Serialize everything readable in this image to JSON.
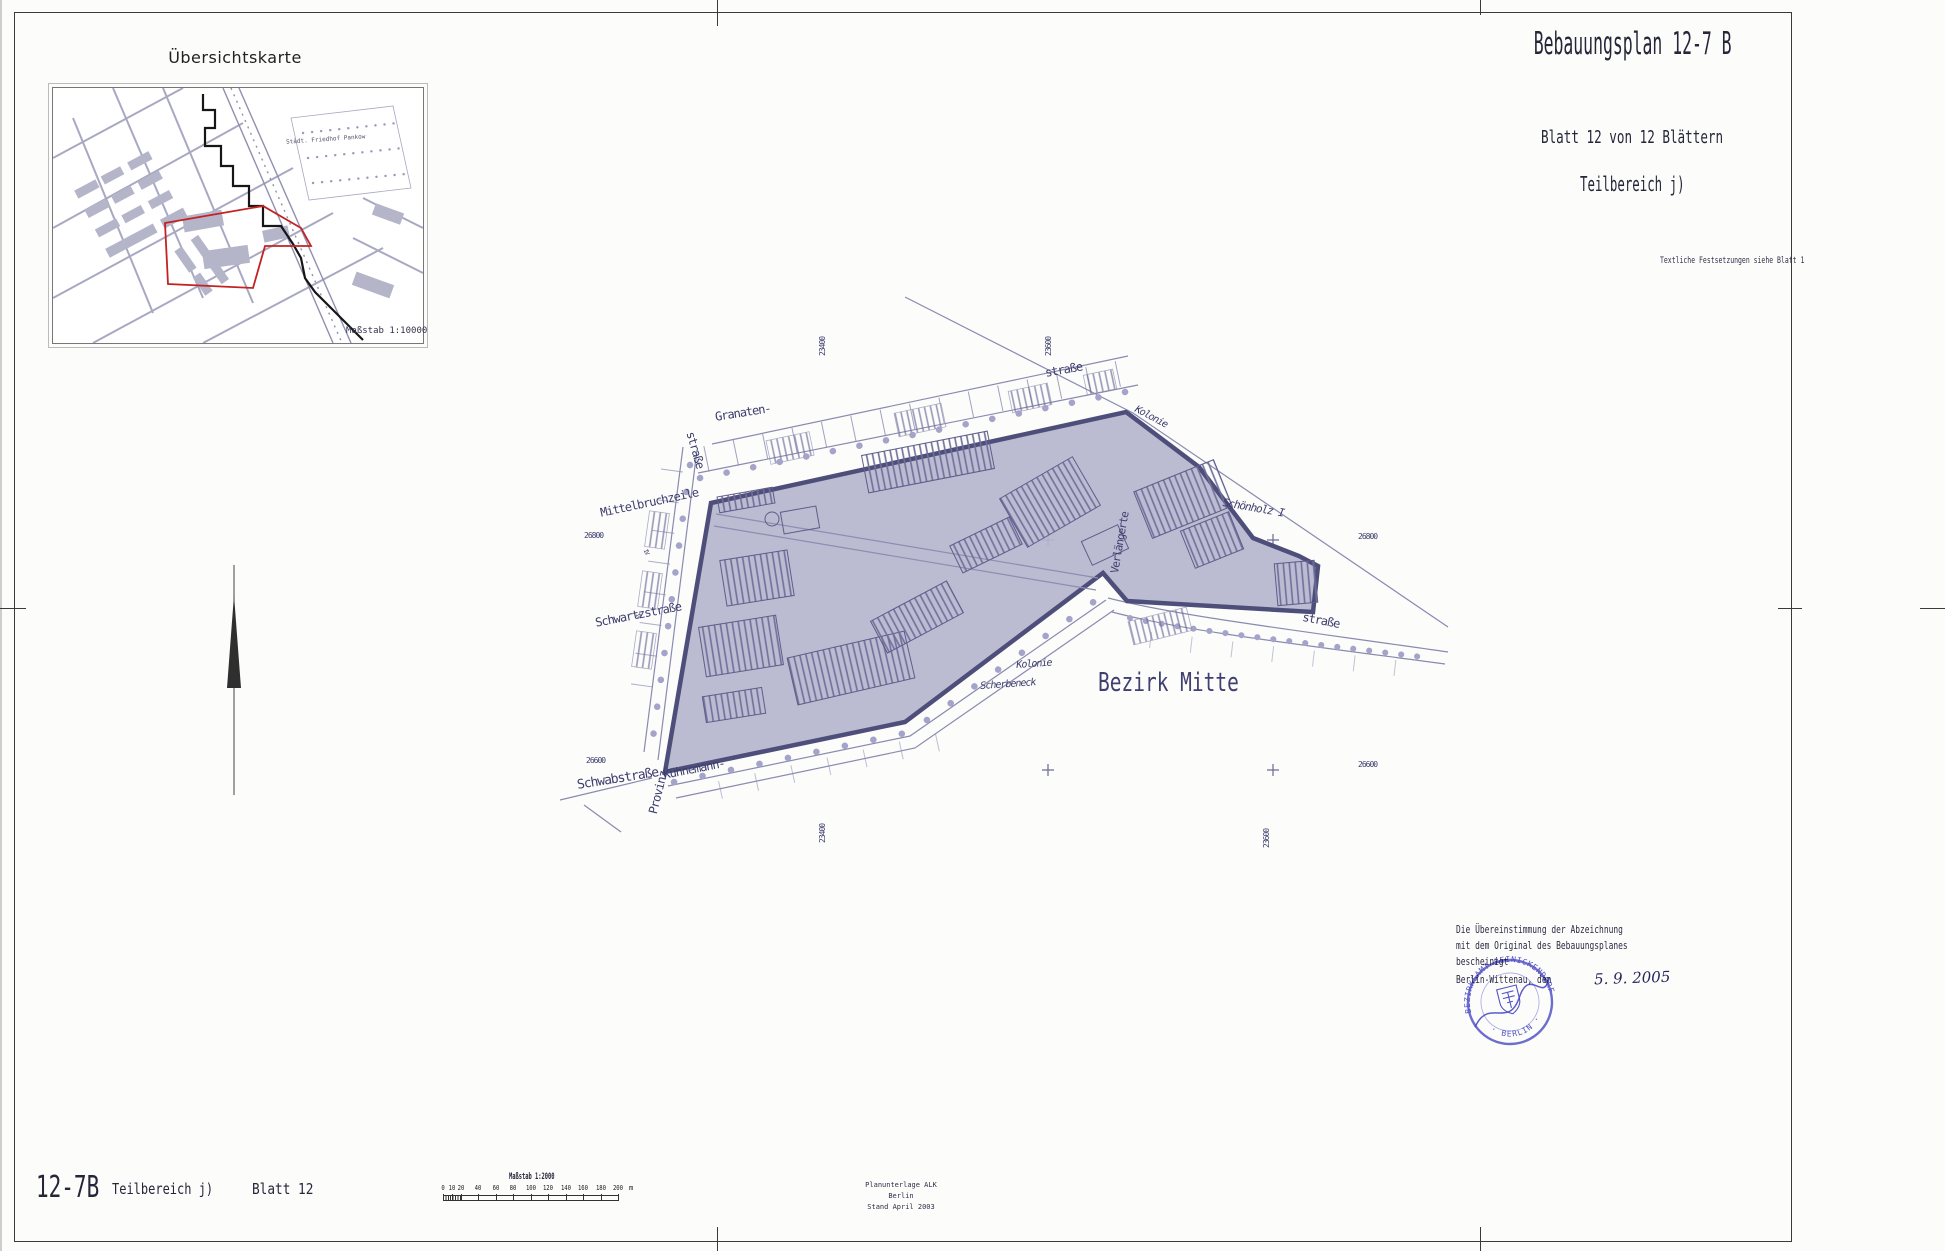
{
  "header": {
    "title": "Bebauungsplan 12-7 B",
    "sheet_info": "Blatt 12 von 12 Blättern",
    "part": "Teilbereich j)",
    "note": "Textliche Festsetzungen siehe Blatt 1"
  },
  "overview": {
    "title": "Übersichtskarte",
    "scale_label": "Maßstab 1:10000",
    "park_label": "Städt. Friedhof Pankow"
  },
  "map_labels": [
    {
      "t": "Granaten-",
      "x": 714,
      "y": 410,
      "r": -9,
      "fs": 12
    },
    {
      "t": "straße",
      "x": 697,
      "y": 430,
      "r": 74,
      "fs": 12
    },
    {
      "t": "straße",
      "x": 1044,
      "y": 366,
      "r": -10,
      "fs": 12
    },
    {
      "t": "Kolonie",
      "x": 1138,
      "y": 404,
      "r": 28,
      "fs": 10,
      "i": 1
    },
    {
      "t": "Mittelbruchzeile",
      "x": 599,
      "y": 506,
      "r": -12,
      "fs": 12
    },
    {
      "t": "Schönholz I",
      "x": 1224,
      "y": 496,
      "r": 10,
      "fs": 11,
      "i": 1
    },
    {
      "t": "Verlängerte",
      "x": 1108,
      "y": 572,
      "r": -80,
      "fs": 11
    },
    {
      "t": "Schwartzstraße",
      "x": 594,
      "y": 616,
      "r": -11,
      "fs": 12
    },
    {
      "t": "Schwabstraße",
      "x": 576,
      "y": 778,
      "r": -9,
      "fs": 13
    },
    {
      "t": "Provinz-",
      "x": 646,
      "y": 812,
      "r": -76,
      "fs": 12
    },
    {
      "t": "Kühnemann-",
      "x": 662,
      "y": 768,
      "r": -11,
      "fs": 12
    },
    {
      "t": "Kolonie",
      "x": 1016,
      "y": 660,
      "r": -4,
      "fs": 10,
      "i": 1
    },
    {
      "t": "Scherbeneck",
      "x": 980,
      "y": 681,
      "r": -4,
      "fs": 10,
      "i": 1
    },
    {
      "t": "straße",
      "x": 1304,
      "y": 610,
      "r": 11,
      "fs": 12
    },
    {
      "t": "Bezirk Mitte",
      "x": 1098,
      "y": 668,
      "fs": 26,
      "sx": 0.75,
      "cls": "district"
    },
    {
      "t": "26800",
      "x": 584,
      "y": 531,
      "fs": 8
    },
    {
      "t": "26800",
      "x": 1358,
      "y": 532,
      "fs": 8
    },
    {
      "t": "26600",
      "x": 586,
      "y": 756,
      "fs": 8
    },
    {
      "t": "26600",
      "x": 1358,
      "y": 760,
      "fs": 8
    },
    {
      "t": "23400",
      "x": 818,
      "y": 356,
      "r": -90,
      "fs": 8
    },
    {
      "t": "23600",
      "x": 1044,
      "y": 356,
      "r": -90,
      "fs": 8
    },
    {
      "t": "23400",
      "x": 818,
      "y": 843,
      "r": -90,
      "fs": 8
    },
    {
      "t": "23600",
      "x": 1262,
      "y": 848,
      "r": -90,
      "fs": 8
    },
    {
      "t": "IV",
      "x": 648,
      "y": 548,
      "r": 64,
      "fs": 6
    },
    {
      "t": "IV",
      "x": 640,
      "y": 612,
      "r": 64,
      "fs": 6
    }
  ],
  "certification": {
    "line1": "Die Übereinstimmung der Abzeichnung",
    "line2": "mit dem Original des Bebauungsplanes",
    "line3": "bescheinigt",
    "place": "Berlin-Wittenau, den",
    "date": "5. 9. 2005",
    "stamp_top": "BEZIRKSAMT REINICKENDORF",
    "stamp_bottom": "· BERLIN ·"
  },
  "footer": {
    "plan_no": "12-7B",
    "part": "Teilbereich j)",
    "sheet": "Blatt 12"
  },
  "scalebar": {
    "title": "Maßstab 1:2000",
    "unit": "m",
    "ticks": [
      {
        "v": "0",
        "x": 0
      },
      {
        "v": "10",
        "x": 9
      },
      {
        "v": "20",
        "x": 18
      },
      {
        "v": "40",
        "x": 35
      },
      {
        "v": "60",
        "x": 53
      },
      {
        "v": "80",
        "x": 70
      },
      {
        "v": "100",
        "x": 88
      },
      {
        "v": "120",
        "x": 105
      },
      {
        "v": "140",
        "x": 123
      },
      {
        "v": "160",
        "x": 140
      },
      {
        "v": "180",
        "x": 158
      },
      {
        "v": "200",
        "x": 175
      }
    ]
  },
  "source": {
    "line1": "Planunterlage ALK Berlin",
    "line2": "Stand April 2003"
  }
}
